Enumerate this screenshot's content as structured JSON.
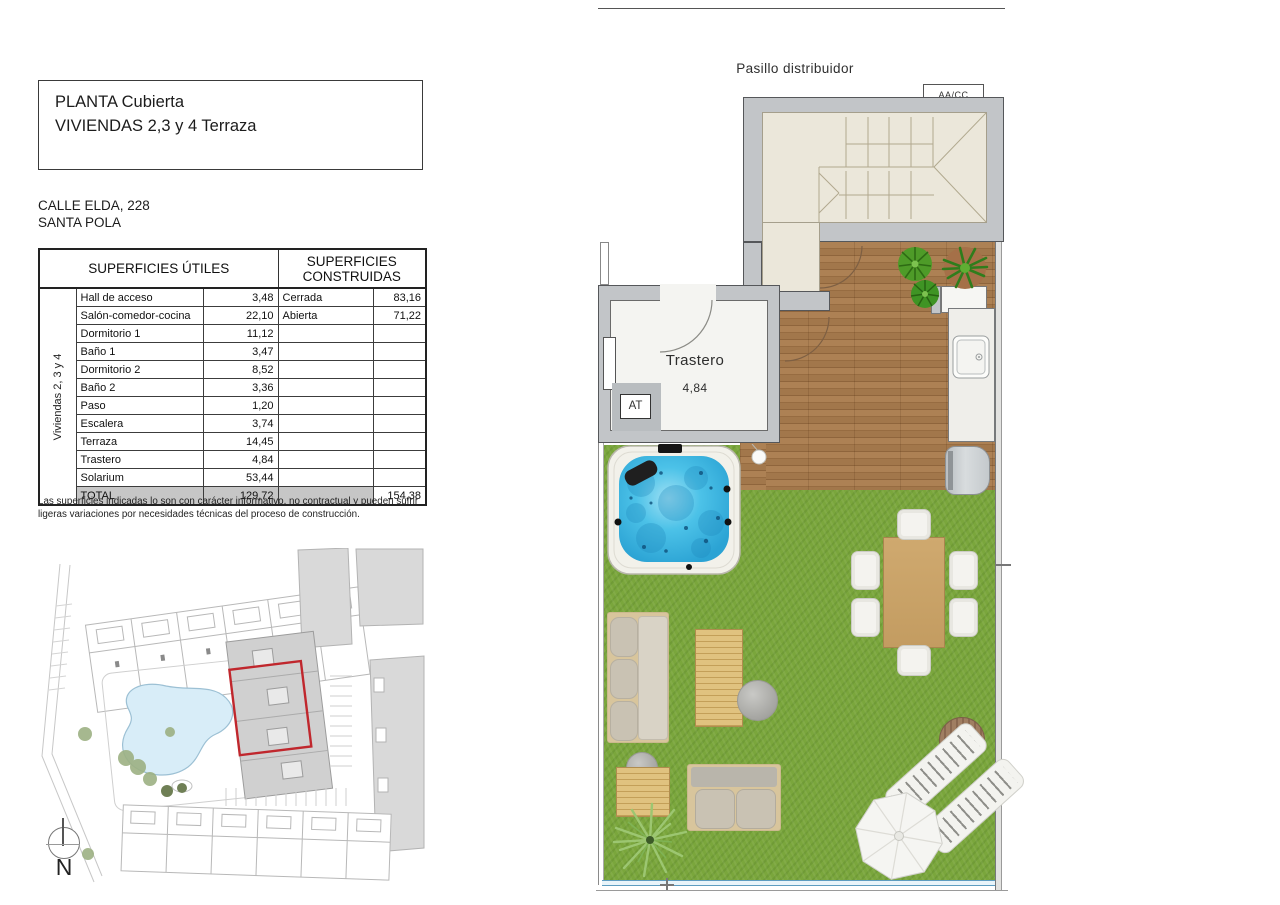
{
  "title_block": {
    "line1": "PLANTA Cubierta",
    "line2": "VIVIENDAS 2,3 y 4 Terraza"
  },
  "address": {
    "line1": "CALLE ELDA, 228",
    "line2": "SANTA POLA"
  },
  "surfaces_table": {
    "group_label": "Viviendas 2, 3 y 4",
    "header_utiles": "SUPERFICIES ÚTILES",
    "header_construidas": "SUPERFICIES CONSTRUIDAS",
    "rows": [
      {
        "name": "Hall de acceso",
        "value": "3,48",
        "cname": "Cerrada",
        "cvalue": "83,16"
      },
      {
        "name": "Salón-comedor-cocina",
        "value": "22,10",
        "cname": "Abierta",
        "cvalue": "71,22"
      },
      {
        "name": "Dormitorio 1",
        "value": "11,12",
        "cname": "",
        "cvalue": ""
      },
      {
        "name": "Baño 1",
        "value": "3,47",
        "cname": "",
        "cvalue": ""
      },
      {
        "name": "Dormitorio 2",
        "value": "8,52",
        "cname": "",
        "cvalue": ""
      },
      {
        "name": "Baño 2",
        "value": "3,36",
        "cname": "",
        "cvalue": ""
      },
      {
        "name": "Paso",
        "value": "1,20",
        "cname": "",
        "cvalue": ""
      },
      {
        "name": "Escalera",
        "value": "3,74",
        "cname": "",
        "cvalue": ""
      },
      {
        "name": "Terraza",
        "value": "14,45",
        "cname": "",
        "cvalue": ""
      },
      {
        "name": "Trastero",
        "value": "4,84",
        "cname": "",
        "cvalue": ""
      },
      {
        "name": "Solarium",
        "value": "53,44",
        "cname": "",
        "cvalue": ""
      }
    ],
    "total": {
      "name": "TOTAL",
      "value": "129,72",
      "cvalue": "154,38"
    }
  },
  "disclaimer": "Las superficies indicadas lo son con carácter informativo, no contractual y pueden sufrir ligeras variaciones por necesidades técnicas del proceso de construcción.",
  "floor_plan": {
    "corridor_label": "Pasillo distribuidor",
    "ac_label": "AA/CC",
    "storage_label": "Trastero",
    "storage_area": "4,84",
    "at_label": "AT"
  },
  "site_plan": {
    "north_label": "N"
  },
  "colors": {
    "wall_grey": "#c2c5c8",
    "roof_cream": "#ebe7da",
    "deck_wood": "#a87a4e",
    "grass_green": "#7aa63c",
    "water_blue": "#4cc2e8",
    "glass_blue": "#5d9cc0",
    "highlight_red": "#c0272d",
    "pool_blue": "#d8edf8"
  }
}
